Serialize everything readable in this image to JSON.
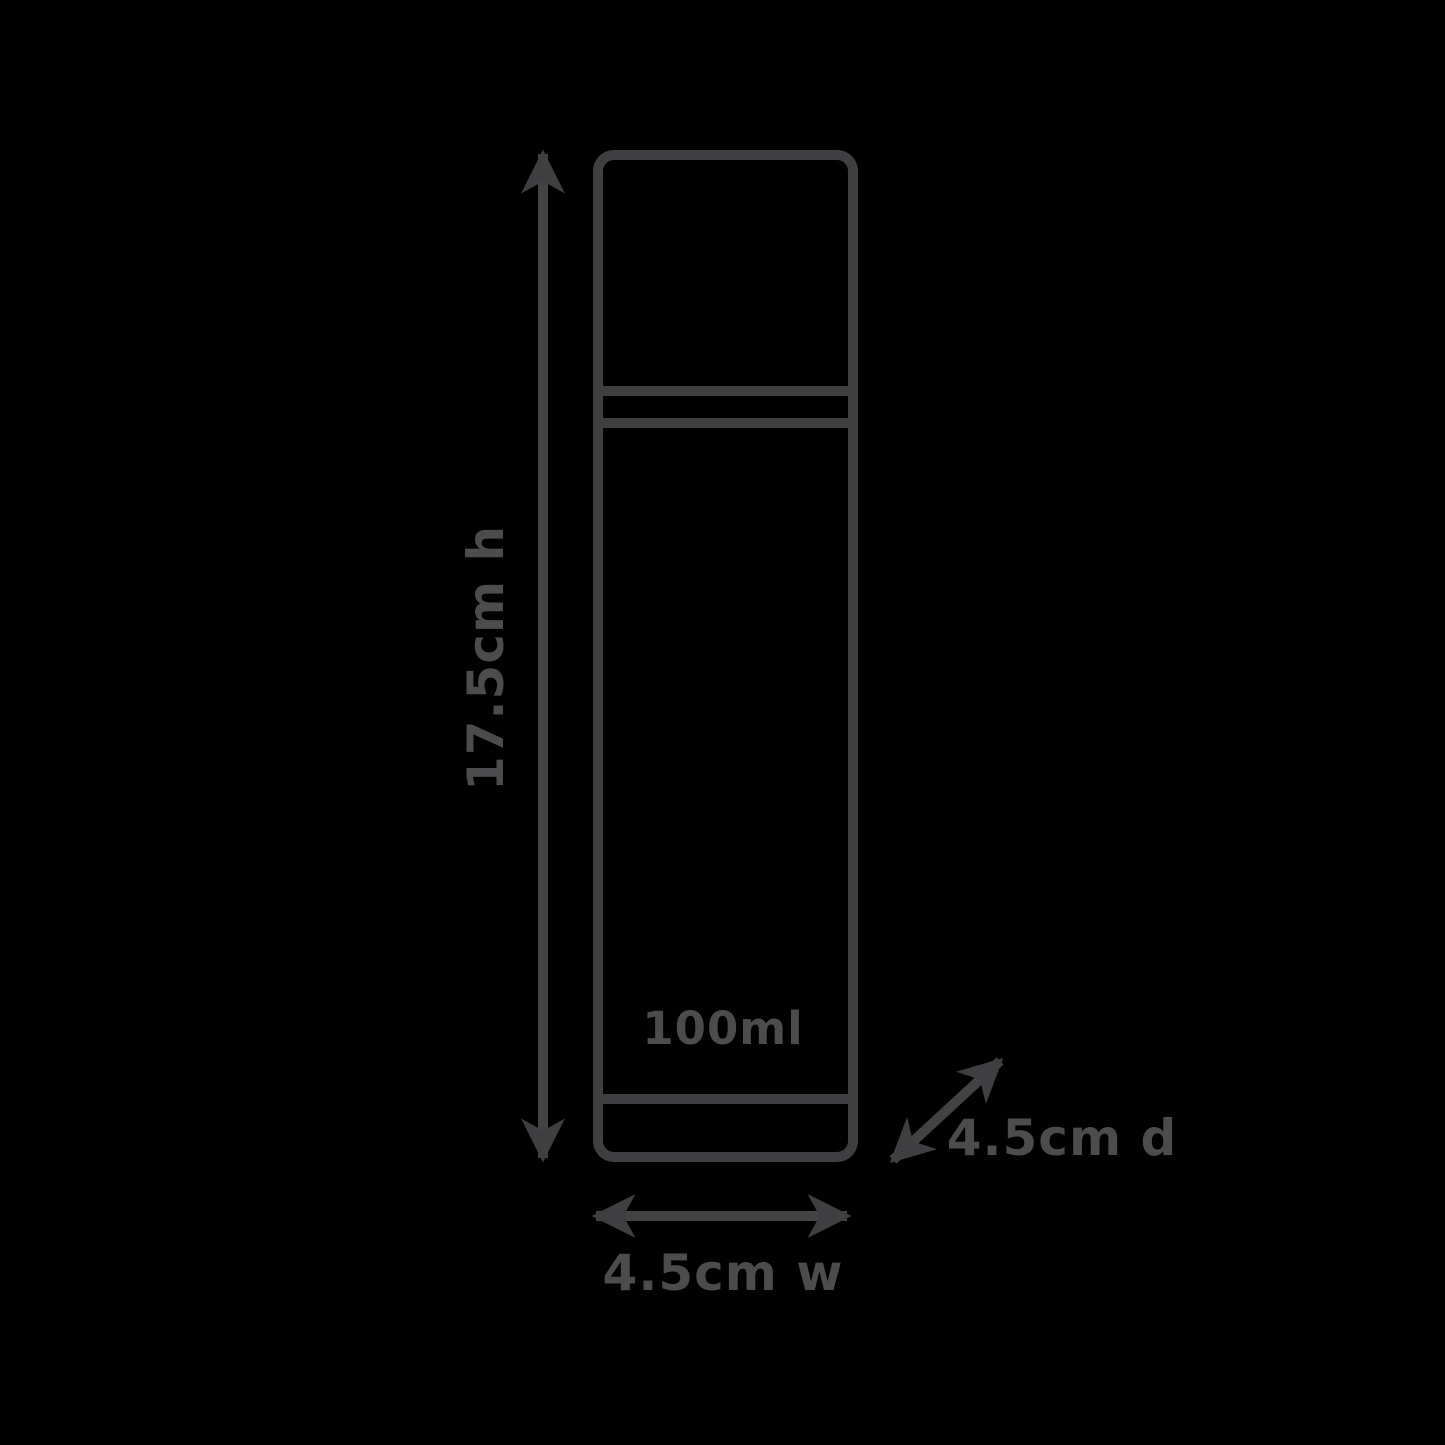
{
  "diagram": {
    "labels": {
      "height": "17.5cm h",
      "volume": "100ml",
      "width": "4.5cm w",
      "depth": "4.5cm d"
    },
    "colors": {
      "background": "#000000",
      "outline": "#3f3f42",
      "text": "#4c4c4f"
    }
  }
}
